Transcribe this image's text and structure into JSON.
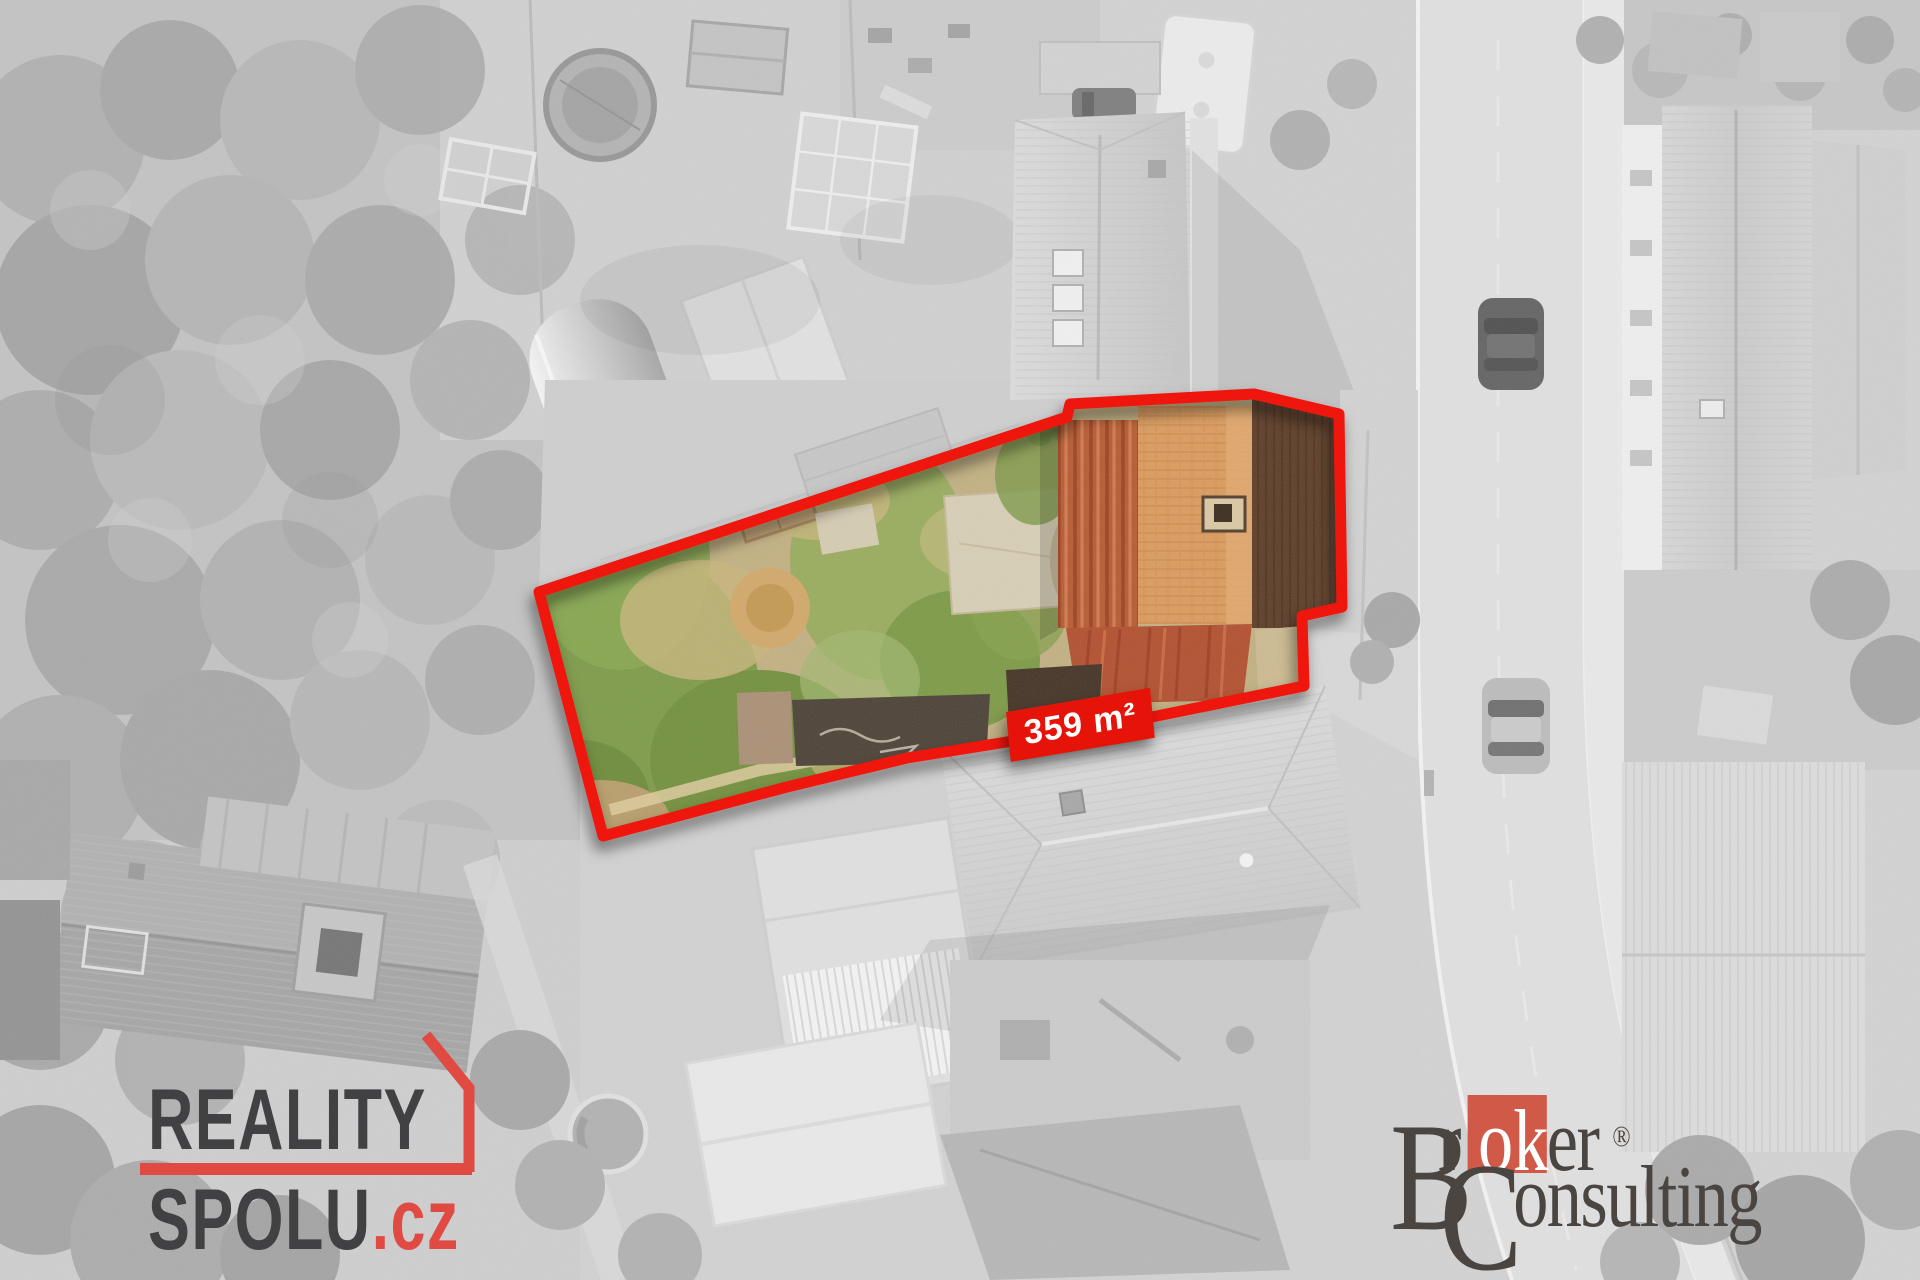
{
  "overlay": {
    "area_label": "359 m²",
    "outline_color": "#ee1409",
    "badge_background": "#e61408",
    "badge_text_color": "#ffffff"
  },
  "branding": {
    "reality_spolu": {
      "line1": "REALITY",
      "line2": "SPOLU",
      "suffix": ".cz",
      "text_color": "#414042",
      "accent_color": "#e04a43"
    },
    "broker_consulting": {
      "prefix_capital": "B",
      "part_r": "r",
      "highlight": "ok",
      "part_er": "er",
      "registered_mark": "®",
      "consulting_capital": "C",
      "consulting_rest": "onsulting",
      "text_color": "#4b4542",
      "highlight_background": "#d05948",
      "highlight_text_color": "#ffffff"
    }
  }
}
